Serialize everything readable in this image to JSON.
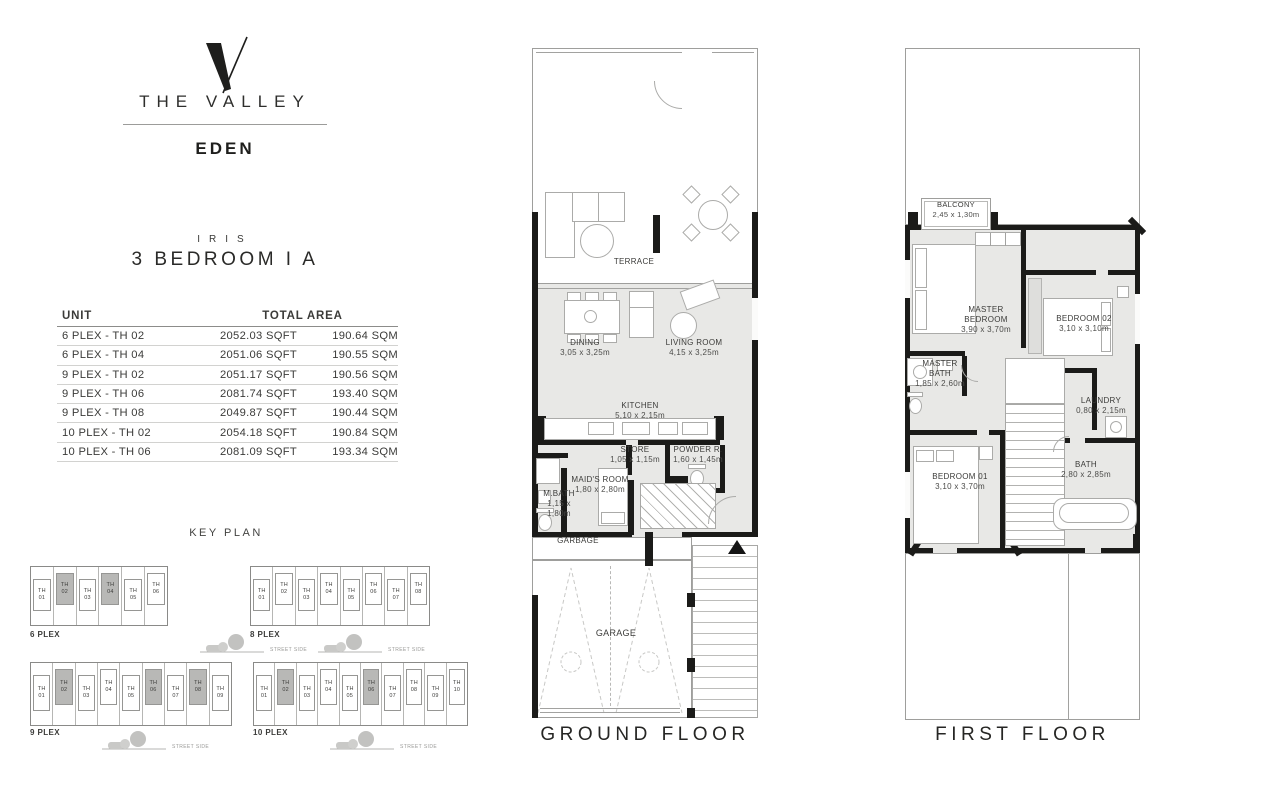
{
  "brand": {
    "name": "THE VALLEY",
    "community": "EDEN"
  },
  "unit_plan": {
    "collection": "IRIS",
    "title": "3 BEDROOM I A"
  },
  "area_table": {
    "col_unit": "UNIT",
    "col_total_area": "TOTAL AREA",
    "rows": [
      {
        "unit": "6 PLEX - TH 02",
        "sqft": "2052.03 SQFT",
        "sqm": "190.64 SQM"
      },
      {
        "unit": "6 PLEX - TH 04",
        "sqft": "2051.06 SQFT",
        "sqm": "190.55 SQM"
      },
      {
        "unit": "9 PLEX - TH 02",
        "sqft": "2051.17 SQFT",
        "sqm": "190.56 SQM"
      },
      {
        "unit": "9 PLEX - TH 06",
        "sqft": "2081.74 SQFT",
        "sqm": "193.40 SQM"
      },
      {
        "unit": "9 PLEX - TH 08",
        "sqft": "2049.87 SQFT",
        "sqm": "190.44 SQM"
      },
      {
        "unit": "10 PLEX - TH 02",
        "sqft": "2054.18 SQFT",
        "sqm": "190.84 SQM"
      },
      {
        "unit": "10 PLEX - TH 06",
        "sqft": "2081.09 SQFT",
        "sqm": "193.34 SQM"
      }
    ]
  },
  "key_plan": {
    "title": "KEY PLAN",
    "street_label": "STREET SIDE",
    "plans": [
      {
        "label": "6 PLEX",
        "units": [
          "TH 01",
          "TH 02",
          "TH 03",
          "TH 04",
          "TH 05",
          "TH 06"
        ],
        "highlighted": [
          1,
          3
        ]
      },
      {
        "label": "8 PLEX",
        "units": [
          "TH 01",
          "TH 02",
          "TH 03",
          "TH 04",
          "TH 05",
          "TH 06",
          "TH 07",
          "TH 08"
        ],
        "highlighted": []
      },
      {
        "label": "9 PLEX",
        "units": [
          "TH 01",
          "TH 02",
          "TH 03",
          "TH 04",
          "TH 05",
          "TH 06",
          "TH 07",
          "TH 08",
          "TH 09"
        ],
        "highlighted": [
          1,
          5,
          7
        ]
      },
      {
        "label": "10 PLEX",
        "units": [
          "TH 01",
          "TH 02",
          "TH 03",
          "TH 04",
          "TH 05",
          "TH 06",
          "TH 07",
          "TH 08",
          "TH 09",
          "TH 10"
        ],
        "highlighted": [
          1,
          5
        ]
      }
    ]
  },
  "ground_floor": {
    "caption": "GROUND FLOOR",
    "rooms": {
      "terrace": {
        "name": "TERRACE"
      },
      "dining": {
        "name": "DINING",
        "dims": "3,05 x 3,25m"
      },
      "living": {
        "name": "LIVING ROOM",
        "dims": "4,15 x 3,25m"
      },
      "kitchen": {
        "name": "KITCHEN",
        "dims": "5,10 x 2,15m"
      },
      "store": {
        "name": "STORE",
        "dims": "1,05 x 1,15m"
      },
      "powder": {
        "name": "POWDER R.",
        "dims": "1,60 x 1,45m"
      },
      "maids": {
        "name": "MAID'S ROOM",
        "dims": "1,80 x 2,80m"
      },
      "mbath": {
        "name": "M.BATH",
        "dims": "1,15 x 1,80m"
      },
      "garbage": {
        "name": "GARBAGE"
      },
      "garage": {
        "name": "GARAGE"
      }
    }
  },
  "first_floor": {
    "caption": "FIRST FLOOR",
    "rooms": {
      "balcony": {
        "name": "BALCONY",
        "dims": "2,45 x 1,30m"
      },
      "master": {
        "name": "MASTER BEDROOM",
        "dims": "3,90 x 3,70m"
      },
      "bedroom2": {
        "name": "BEDROOM 02",
        "dims": "3,10 x 3,10m"
      },
      "masterbath": {
        "name": "MASTER BATH",
        "dims": "1,85 x 2,60m"
      },
      "laundry": {
        "name": "LAUNDRY",
        "dims": "0,80 x 2,15m"
      },
      "bedroom1": {
        "name": "BEDROOM 01",
        "dims": "3,10 x 3,70m"
      },
      "bath": {
        "name": "BATH",
        "dims": "2,80 x 2,85m"
      }
    }
  },
  "colors": {
    "wall": "#1b1b19",
    "floor": "#e8e8e6",
    "line": "#a2a2a0",
    "highlight": "#b8b8b6",
    "text": "#3b3b39"
  }
}
